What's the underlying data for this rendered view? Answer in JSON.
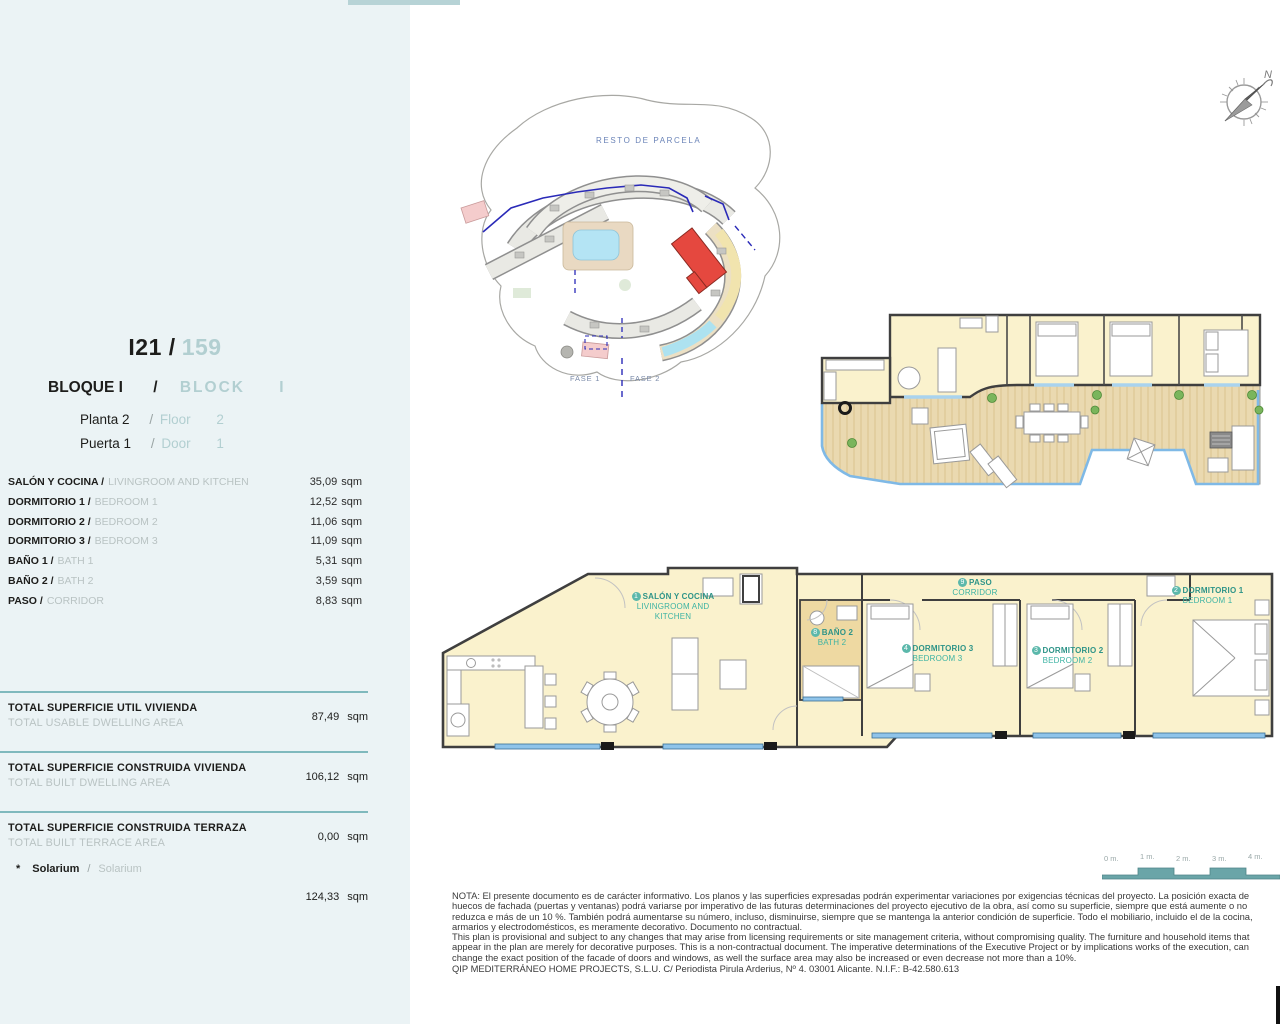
{
  "sidebar": {
    "unit": {
      "code": "I21 /",
      "number": "159"
    },
    "block": {
      "es": "BLOQUE I",
      "slash": "/",
      "en": "BLOCK",
      "en_num": "I"
    },
    "planta": {
      "es": "Planta 2",
      "slash": "/",
      "en": "Floor",
      "num": "2"
    },
    "puerta": {
      "es": "Puerta 1",
      "slash": "/",
      "en": "Door",
      "num": "1"
    },
    "rooms": [
      {
        "es": "SALÓN Y COCINA /",
        "en": "LIVINGROOM AND KITCHEN",
        "area": "35,09",
        "unit": "sqm"
      },
      {
        "es": "DORMITORIO 1 /",
        "en": "BEDROOM 1",
        "area": "12,52",
        "unit": "sqm"
      },
      {
        "es": "DORMITORIO 2 /",
        "en": "BEDROOM 2",
        "area": "11,06",
        "unit": "sqm"
      },
      {
        "es": "DORMITORIO 3 /",
        "en": "BEDROOM 3",
        "area": "11,09",
        "unit": "sqm"
      },
      {
        "es": "BAÑO 1 /",
        "en": "BATH 1",
        "area": "5,31",
        "unit": "sqm"
      },
      {
        "es": "BAÑO 2 /",
        "en": "BATH 2",
        "area": "3,59",
        "unit": "sqm"
      },
      {
        "es": "PASO /",
        "en": "CORRIDOR",
        "area": "8,83",
        "unit": "sqm"
      }
    ],
    "totals": [
      {
        "es": "TOTAL SUPERFICIE UTIL VIVIENDA",
        "en": "TOTAL USABLE DWELLING AREA",
        "area": "87,49",
        "unit": "sqm"
      },
      {
        "es": "TOTAL SUPERFICIE CONSTRUIDA VIVIENDA",
        "en": "TOTAL BUILT DWELLING AREA",
        "area": "106,12",
        "unit": "sqm"
      },
      {
        "es": "TOTAL SUPERFICIE CONSTRUIDA TERRAZA",
        "en": "TOTAL BUILT TERRACE AREA",
        "area": "0,00",
        "unit": "sqm"
      }
    ],
    "solarium": {
      "star": "*",
      "es": "Solarium",
      "slash": "/",
      "en": "Solarium",
      "area": "124,33",
      "unit": "sqm"
    }
  },
  "site_plan": {
    "resto": "RESTO DE PARCELA",
    "fase1": "FASE 1",
    "fase2": "FASE 2"
  },
  "compass": {
    "north": "N"
  },
  "floor_plan": {
    "labels": {
      "salon": {
        "num": "1",
        "es": "SALÓN Y COCINA",
        "en1": "LIVINGROOM AND",
        "en2": "KITCHEN"
      },
      "paso": {
        "num": "9",
        "es": "PASO",
        "en": "CORRIDOR"
      },
      "bano2": {
        "num": "8",
        "es": "BAÑO 2",
        "en": "BATH 2"
      },
      "dorm3": {
        "num": "4",
        "es": "DORMITORIO 3",
        "en": "BEDROOM 3"
      },
      "dorm2": {
        "num": "3",
        "es": "DORMITORIO 2",
        "en": "BEDROOM 2"
      },
      "dorm1": {
        "num": "2",
        "es": "DORMITORIO 1",
        "en": "BEDROOM 1"
      }
    }
  },
  "scale_bar": {
    "labels": [
      "0 m.",
      "1 m.",
      "2 m.",
      "3 m.",
      "4 m."
    ]
  },
  "disclaimer": {
    "es_lines": [
      "NOTA: El presente documento es de carácter informativo. Los planos y las superficies expresadas podrán experimentar variaciones por exigencias técnicas del proyecto. La posición exacta de",
      "huecos de fachada (puertas y ventanas) podrá variarse por imperativo de las futuras determinaciones del proyecto ejecutivo de la obra, así como su superficie, siempre que está aumente o no",
      "reduzca e más de un 10 %. También podrá aumentarse su número, incluso, disminuirse, siempre que se mantenga la anterior condición de superficie. Todo el mobiliario, incluido el de la cocina,",
      "armarios y electrodomésticos, es meramente decorativo. Documento no contractual."
    ],
    "en_lines": [
      "This plan is provisional and subject to any changes that may arise from licensing requirements or site management criteria, without compromising quality. The furniture and household items that",
      "appear in the plan are merely for decorative purposes. This is a non-contractual document. The imperative determinations of the Executive Project or by implications works of the execution, can",
      "change the exact position of the facade of doors and windows, as well the surface area may also be increased or even decrease not more than a 10%."
    ],
    "company": "QIP MEDITERRÁNEO HOME PROJECTS, S.L.U. C/ Periodista Pirula Arderius, Nº 4. 03001 Alicante. N.I.F.: B-42.580.613"
  },
  "colors": {
    "sidebar_bg": "#ebf3f5",
    "accent_teal": "#7fb9bd",
    "light_teal_text": "#b2cfd1",
    "label_teal": "#2e9488",
    "room_fill": "#faf2cd",
    "bath_fill": "#eed9a2",
    "deck_fill": "#ead9b0",
    "balustrade_blue": "#7fb9e6",
    "window_blue": "#8fc4ea",
    "highlight_red": "#e5483f",
    "dark_text": "#1d1d1b"
  }
}
